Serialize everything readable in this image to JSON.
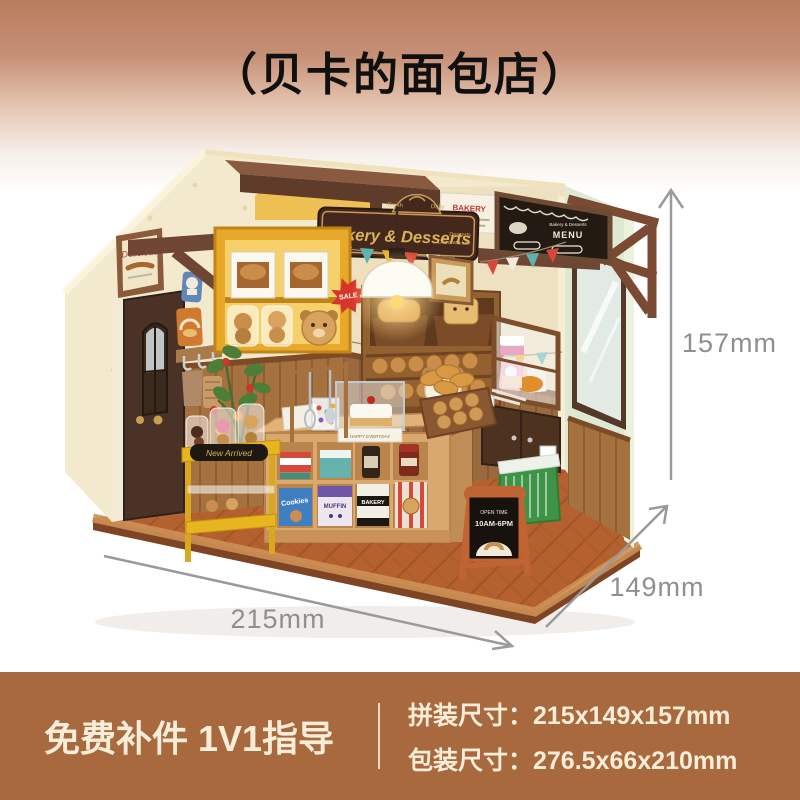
{
  "page": {
    "title": "（贝卡的面包店）"
  },
  "model": {
    "hanging_sign": {
      "brand": "Rolife",
      "title": "Bakery & Desserts",
      "badge_left": "Fresh",
      "badge_right": "Daily",
      "tagline_1": "Desserts",
      "tagline_2": "Decorate Life"
    },
    "menu_board": {
      "subtitle": "Bakery & Desserts",
      "title": "MENU"
    },
    "wall_poster": {
      "title": "BAKERY"
    },
    "frame_picture": {
      "title": "Delicious"
    },
    "sale_badge": "SALE",
    "cart_sign": "New Arrived",
    "floor_sign": {
      "line1": "OPEN TIME",
      "line2": "10AM-6PM"
    },
    "cake_stand": "HAPPY EVERYDAY",
    "boxes": {
      "cookies": "Cookies",
      "muffin": "MUFFIN",
      "bakery": "BAKERY"
    }
  },
  "dimensions": {
    "height": "157mm",
    "depth": "149mm",
    "width": "215mm"
  },
  "banner": {
    "left_text": "免费补件 1V1指导",
    "assembly": "拼装尺寸：215x149x157mm",
    "package": "包装尺寸：276.5x66x210mm"
  },
  "colors": {
    "background_top": "#b97d5e",
    "banner_background": "#a8693f",
    "banner_text": "#f8edd9",
    "title_text": "#101010",
    "dimension_gray": "#8f8f8f",
    "wall_cream": "#f3e9cc",
    "floor_orange": "#b4612f",
    "wood_dark": "#6f4534",
    "shelf_yellow": "#e8a82a",
    "mint_wall": "#dfe8d2"
  }
}
